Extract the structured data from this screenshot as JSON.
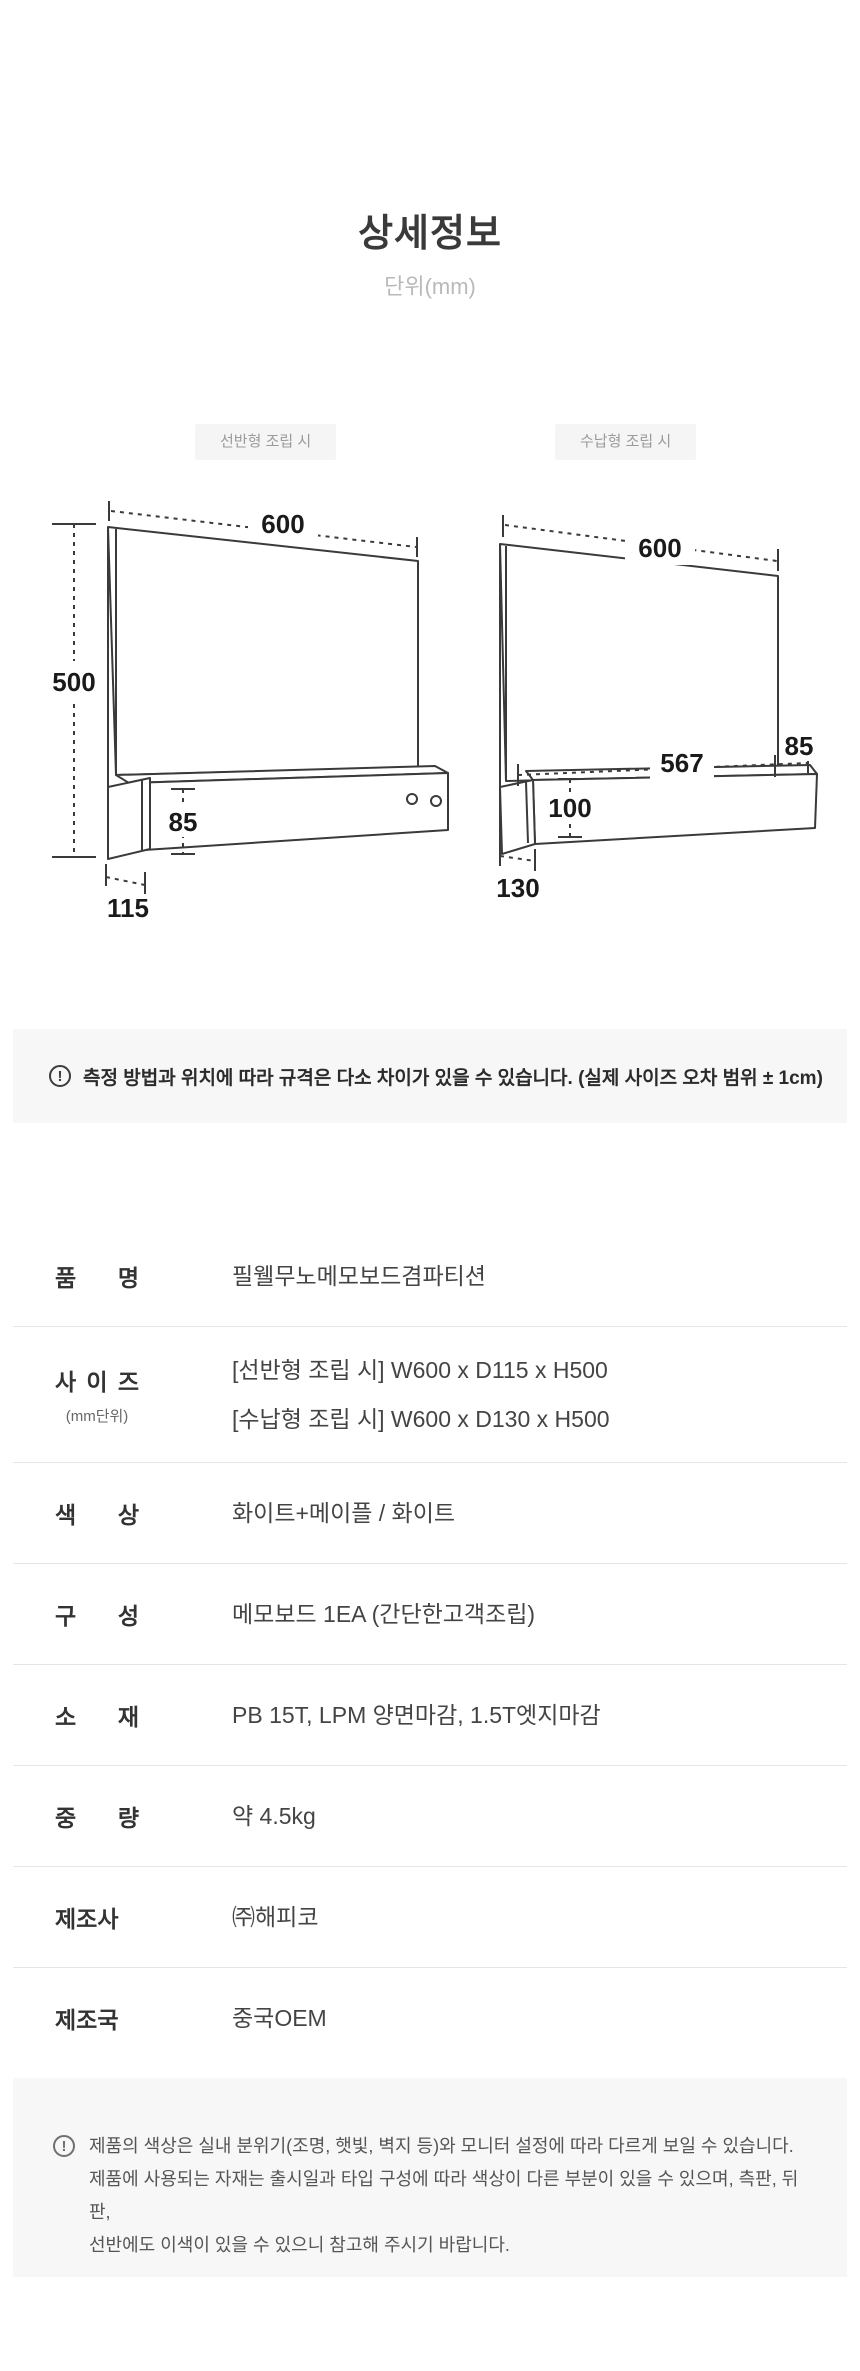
{
  "page": {
    "title": "상세정보",
    "unit_label": "단위(mm)"
  },
  "colors": {
    "notice_background": "#f7f7f7",
    "badge_background": "#f5f5f5",
    "line_color": "#3a3a3a",
    "separator": "#e5e5e5"
  },
  "diagrams": {
    "shelf_type": {
      "badge": "선반형 조립 시",
      "dims": {
        "width": "600",
        "height": "500",
        "shelf_front_height": "85",
        "depth": "115"
      }
    },
    "storage_type": {
      "badge": "수납형 조립 시",
      "dims": {
        "width": "600",
        "inner_width": "567",
        "side_gap": "85",
        "box_height": "100",
        "depth": "130"
      }
    }
  },
  "notice_bar": {
    "icon": "exclamation-circle-icon",
    "text": "측정 방법과 위치에 따라 규격은 다소 차이가 있을 수 있습니다. (실제 사이즈 오차 범위 ± 1cm)"
  },
  "spec_table": {
    "rows": [
      {
        "label": "품 명",
        "values": [
          "필웰무노메모보드겸파티션"
        ]
      },
      {
        "label": "사 이 즈",
        "sublabel": "(mm단위)",
        "values": [
          "[선반형 조립 시] W600 x D115 x H500",
          "[수납형 조립 시] W600 x D130 x H500"
        ]
      },
      {
        "label": "색 상",
        "values": [
          "화이트+메이플 / 화이트"
        ]
      },
      {
        "label": "구 성",
        "values": [
          "메모보드 1EA (간단한고객조립)"
        ]
      },
      {
        "label": "소 재",
        "values": [
          "PB 15T, LPM 양면마감, 1.5T엣지마감"
        ]
      },
      {
        "label": "중 량",
        "values": [
          "약 4.5kg"
        ]
      },
      {
        "label": "제조사",
        "values": [
          "㈜해피코"
        ]
      },
      {
        "label": "제조국",
        "values": [
          "중국OEM"
        ]
      }
    ]
  },
  "footer_notice": {
    "icon": "exclamation-circle-icon",
    "lines": [
      "제품의 색상은 실내 분위기(조명, 햇빛, 벽지 등)와 모니터 설정에 따라 다르게 보일 수 있습니다.",
      "제품에 사용되는 자재는 출시일과 타입 구성에 따라 색상이 다른 부분이 있을 수 있으며, 측판, 뒤판,",
      "선반에도 이색이 있을 수 있으니 참고해 주시기 바랍니다."
    ]
  }
}
